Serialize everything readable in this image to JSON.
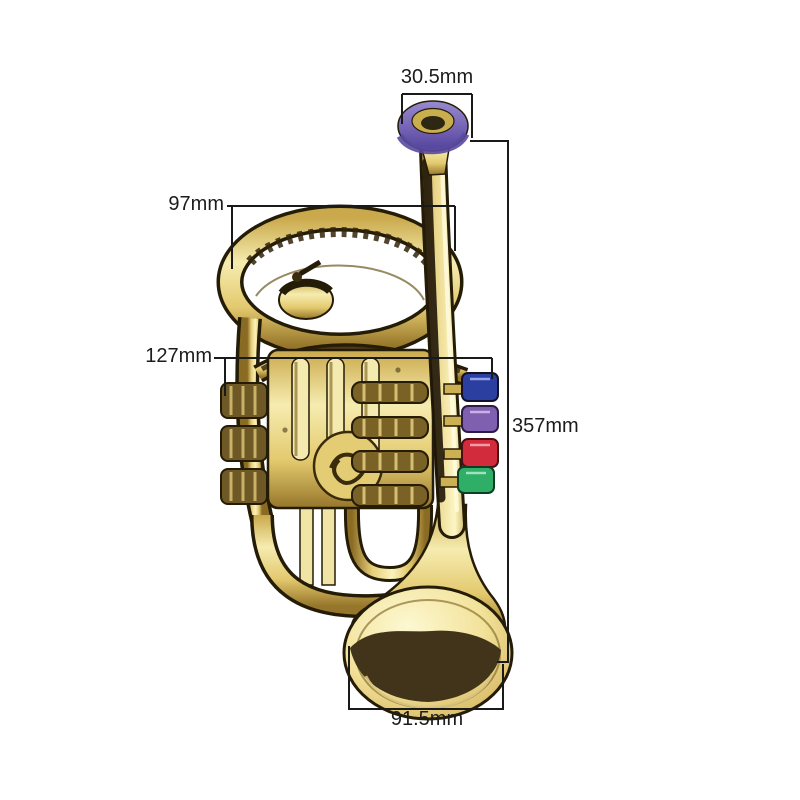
{
  "image": {
    "kind": "product dimension diagram",
    "subject": "gold toy trumpet (cornet style) with purple mouthpiece ring and four colored valve buttons, bell facing down",
    "background": "#ffffff"
  },
  "measurements": {
    "mouthpiece_width": "30.5mm",
    "upper_loop_width": "97mm",
    "valve_section_width": "127mm",
    "overall_height": "357mm",
    "bell_diameter": "91.5mm"
  },
  "colors": {
    "background": "#ffffff",
    "body-gold": "#e8d17a",
    "body-gold-light": "#fbf3bc",
    "body-shadow": "#6b571f",
    "outline-dark": "#241c06",
    "ring-purple": "#7463b4",
    "button-blue": "#2a3f9f",
    "button-purple": "#7e5fb0",
    "button-red": "#d22c3c",
    "button-green": "#2fae67",
    "dimension-line": "#1a1a1a",
    "label-text": "#1c1c1c"
  }
}
